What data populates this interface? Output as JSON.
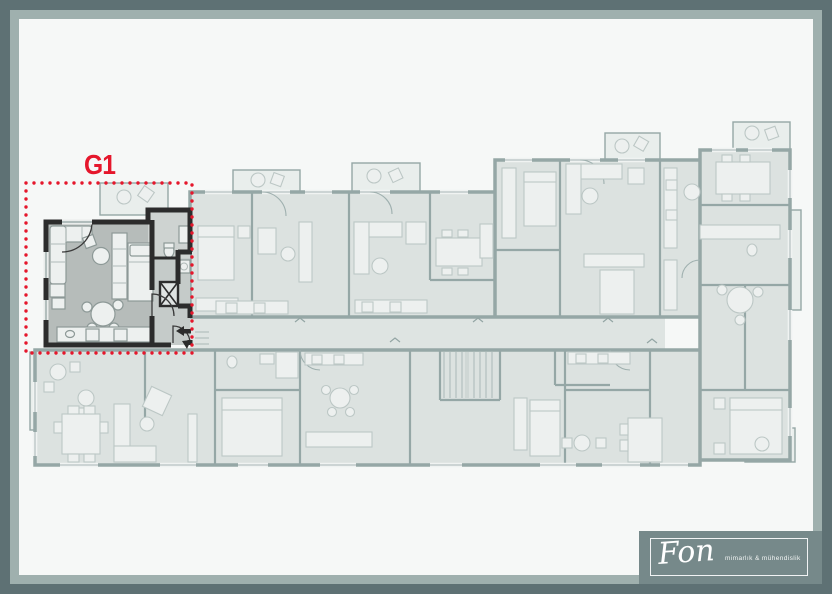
{
  "plan": {
    "unit_label": "G1",
    "highlighted_unit": "G1"
  },
  "logo": {
    "brand": "Fon",
    "tagline": "mimarlık & mühendislik"
  },
  "colors": {
    "accent": "#e5172c",
    "frame_outer": "#5e7174",
    "frame_inner": "#9fb0ae",
    "paper": "#f6f8f7",
    "wall_dark": "#2c2c2c",
    "unit_room": "#b6bcba",
    "unit_hall": "#c5cbc9",
    "unit_bath": "#ced3d1",
    "faded_wall": "#95a7a6",
    "faded_room": "#dce2e0",
    "faded_balcony": "#e9eeec",
    "furniture": "#edf0ef",
    "furniture_stroke": "#bcc7c5",
    "logo_bg": "#76898a",
    "logo_text": "#f2f5f4"
  }
}
